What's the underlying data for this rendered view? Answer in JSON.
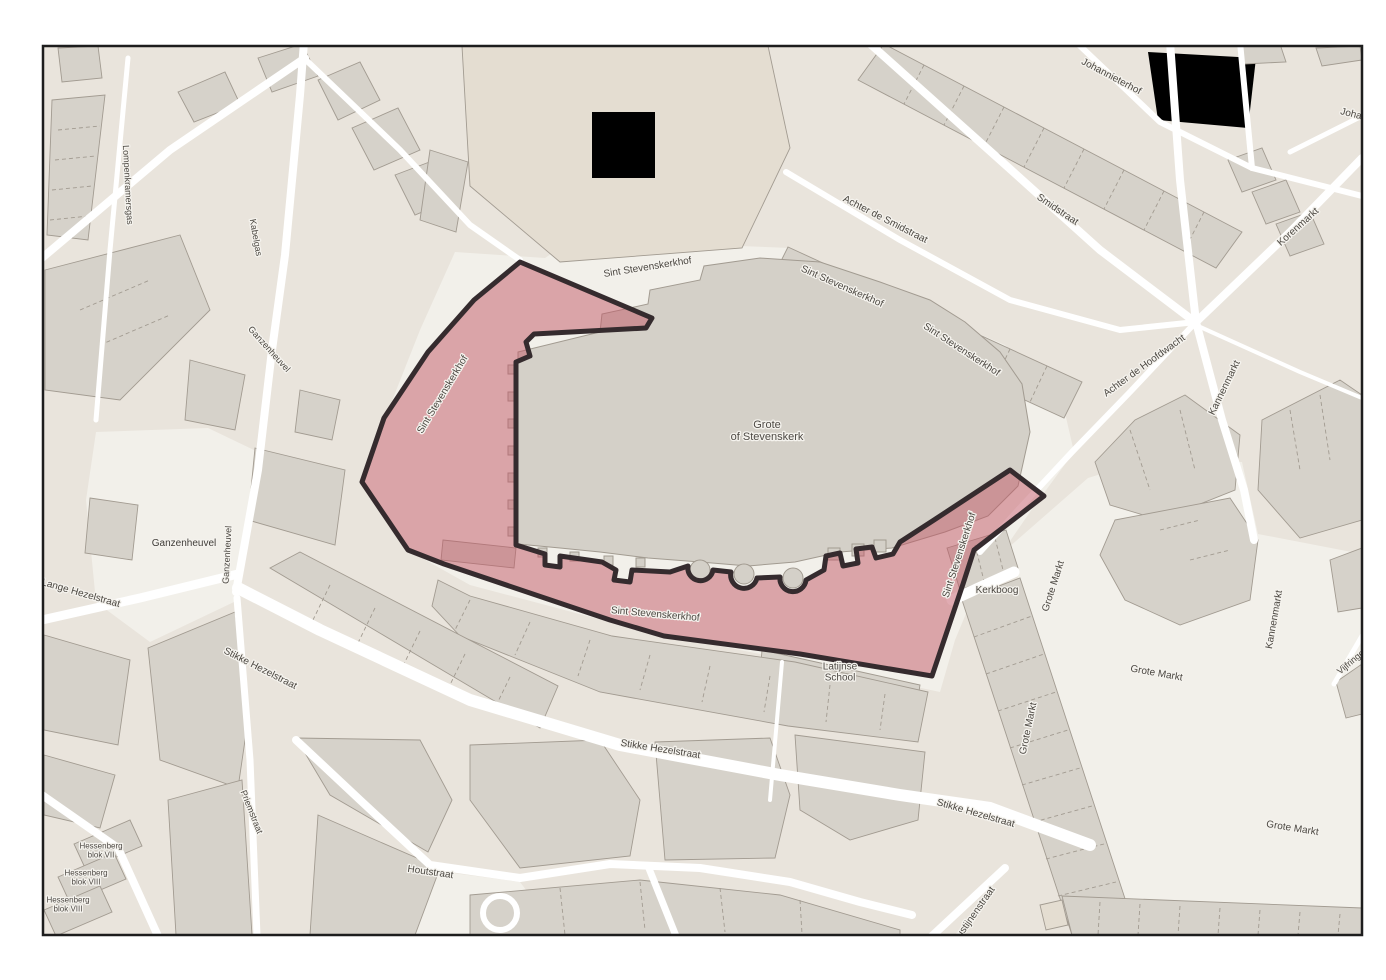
{
  "map": {
    "palette": {
      "page_bg": "#ffffff",
      "frame": "#1d1d1d",
      "base": "#e9e4dc",
      "pedestrian": "#f2f0ea",
      "road": "#ffffff",
      "building": "#d6d2ca",
      "building_pale": "#e4ddd1",
      "building_outline": "#a29b91",
      "church": "#d4d0c8",
      "grass": "#cdd9ae",
      "sand": "#dbcda0",
      "highlight_fill": "#c25866",
      "highlight_fill_opacity": "0.5",
      "highlight_border": "#352b2e",
      "label": "#4b4741",
      "label_place": "#3f3c38",
      "label_poi": "#4e4a45",
      "halo": "#f5f3ee"
    },
    "labels": [
      {
        "id": "grote-of-stevenskerk",
        "kind": "poi",
        "lines": [
          "Grote",
          "of Stevenskerk"
        ],
        "x": 767,
        "y": 434,
        "rot": 0,
        "size": 11
      },
      {
        "id": "sint-stevenskerkhof-top",
        "text": "Sint Stevenskerkhof",
        "x": 648,
        "y": 270,
        "rot": -9,
        "size": 10
      },
      {
        "id": "sint-stevenskerkhof-west",
        "text": "Sint Stevenskerkhof",
        "x": 445,
        "y": 396,
        "rot": -59,
        "size": 10
      },
      {
        "id": "sint-stevenskerkhof-ne1",
        "text": "Sint Stevenskerkhof",
        "x": 841,
        "y": 289,
        "rot": 24,
        "size": 10
      },
      {
        "id": "sint-stevenskerkhof-ne2",
        "text": "Sint Stevenskerkhof",
        "x": 960,
        "y": 352,
        "rot": 33,
        "size": 10
      },
      {
        "id": "sint-stevenskerkhof-east",
        "text": "Sint Stevenskerkhof",
        "x": 962,
        "y": 556,
        "rot": -72,
        "size": 10
      },
      {
        "id": "sint-stevenskerkhof-south",
        "text": "Sint Stevenskerkhof",
        "x": 655,
        "y": 617,
        "rot": 5,
        "size": 10
      },
      {
        "id": "achter-de-smidstraat",
        "text": "Achter de Smidstraat",
        "x": 884,
        "y": 222,
        "rot": 27,
        "size": 10
      },
      {
        "id": "smidstraat",
        "text": "Smidstraat",
        "x": 1056,
        "y": 212,
        "rot": 34,
        "size": 10
      },
      {
        "id": "johannieterhof",
        "text": "Johannieterhof",
        "x": 1110,
        "y": 79,
        "rot": 28,
        "size": 10
      },
      {
        "id": "johannieterhof-east",
        "text": "Johannieterhof",
        "x": 1372,
        "y": 122,
        "rot": 14,
        "size": 10
      },
      {
        "id": "achter-de-hoofdwacht",
        "text": "Achter de Hoofdwacht",
        "x": 1146,
        "y": 368,
        "rot": -36,
        "size": 10
      },
      {
        "id": "kannenmarkt-north",
        "text": "Kannenmarkt",
        "x": 1227,
        "y": 389,
        "rot": -64,
        "size": 10
      },
      {
        "id": "korenmarkt",
        "text": "Korenmarkt",
        "x": 1300,
        "y": 229,
        "rot": -42,
        "size": 10
      },
      {
        "id": "kannenmarkt-south",
        "text": "Kannenmarkt",
        "x": 1277,
        "y": 620,
        "rot": -80,
        "size": 10
      },
      {
        "id": "vijfringengas",
        "text": "Vijfringengas",
        "x": 1360,
        "y": 658,
        "rot": -40,
        "size": 9
      },
      {
        "id": "kerkboog",
        "text": "Kerkboog",
        "x": 997,
        "y": 593,
        "rot": 0,
        "size": 10
      },
      {
        "id": "grote-markt-1",
        "text": "Grote Markt",
        "x": 1056,
        "y": 587,
        "rot": -72,
        "size": 10
      },
      {
        "id": "grote-markt-2",
        "text": "Grote Markt",
        "x": 1156,
        "y": 676,
        "rot": 10,
        "size": 10
      },
      {
        "id": "grote-markt-3",
        "text": "Grote Markt",
        "x": 1031,
        "y": 729,
        "rot": -78,
        "size": 10
      },
      {
        "id": "grote-markt-4",
        "text": "Grote Markt",
        "x": 1292,
        "y": 831,
        "rot": 9,
        "size": 10
      },
      {
        "id": "stikke-hezelstraat-w",
        "text": "Stikke Hezelstraat",
        "x": 259,
        "y": 671,
        "rot": 27,
        "size": 10
      },
      {
        "id": "stikke-hezelstraat-m",
        "text": "Stikke Hezelstraat",
        "x": 660,
        "y": 752,
        "rot": 9,
        "size": 10
      },
      {
        "id": "stikke-hezelstraat-e",
        "text": "Stikke Hezelstraat",
        "x": 975,
        "y": 816,
        "rot": 16,
        "size": 10
      },
      {
        "id": "lange-hezelstraat",
        "text": "Lange Hezelstraat",
        "x": 80,
        "y": 596,
        "rot": 16,
        "size": 10
      },
      {
        "id": "ganzenheuvel-place",
        "kind": "place",
        "text": "Ganzenheuvel",
        "x": 184,
        "y": 546,
        "rot": 0,
        "size": 10
      },
      {
        "id": "ganzenheuvel-street-v",
        "text": "Ganzenheuvel",
        "x": 230,
        "y": 555,
        "rot": -87,
        "size": 9
      },
      {
        "id": "ganzenheuvel-street-d",
        "text": "Ganzenheuvel",
        "x": 267,
        "y": 351,
        "rot": 48,
        "size": 9
      },
      {
        "id": "lompenkramersgas",
        "text": "Lompenkramersgas",
        "x": 125,
        "y": 185,
        "rot": 87,
        "size": 9
      },
      {
        "id": "kabelgas",
        "text": "Kabelgas",
        "x": 253,
        "y": 238,
        "rot": 80,
        "size": 9
      },
      {
        "id": "priemstraat",
        "text": "Priemstraat",
        "x": 249,
        "y": 813,
        "rot": 68,
        "size": 9
      },
      {
        "id": "houtstraat",
        "text": "Houtstraat",
        "x": 430,
        "y": 875,
        "rot": 8,
        "size": 10
      },
      {
        "id": "latijnse-school",
        "kind": "poi",
        "lines": [
          "Latijnse",
          "School"
        ],
        "x": 840,
        "y": 675,
        "rot": 0,
        "size": 10
      },
      {
        "id": "hessenberg-blok-vii",
        "kind": "poi",
        "lines": [
          "Hessenberg",
          "blok VII"
        ],
        "x": 101,
        "y": 853,
        "rot": 0,
        "size": 8
      },
      {
        "id": "hessenberg-blok-viii-a",
        "kind": "poi",
        "lines": [
          "Hessenberg",
          "blok VIII"
        ],
        "x": 86,
        "y": 880,
        "rot": 0,
        "size": 8
      },
      {
        "id": "hessenberg-blok-viii-b",
        "kind": "poi",
        "lines": [
          "Hessenberg",
          "blok VIII"
        ],
        "x": 68,
        "y": 907,
        "rot": 0,
        "size": 8
      },
      {
        "id": "augustijnenstraat",
        "text": "Augustijnenstraat",
        "x": 973,
        "y": 921,
        "rot": -55,
        "size": 10
      }
    ]
  }
}
